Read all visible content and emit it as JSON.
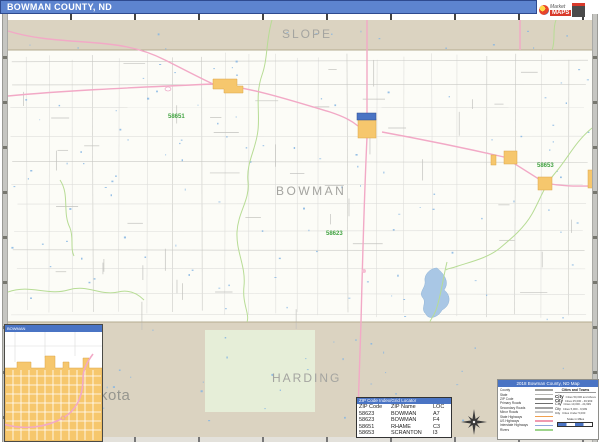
{
  "title_bar": {
    "title": "BOWMAN COUNTY, ND",
    "bg": "#5d84cf"
  },
  "logo": {
    "word1": "Market",
    "word2": "MAPS"
  },
  "map": {
    "neighbor_top": "SLOPE",
    "county": "BOWMAN",
    "neighbor_bottom": "HARDING",
    "partial_state_label": "kota",
    "zip_labels": [
      "58651",
      "58623",
      "58653"
    ],
    "colors": {
      "neighbor_band": "#dbd3c1",
      "county_fill": "#fcfcf7",
      "highway": "#f2a9c6",
      "stream": "#b7dc95",
      "water": "#a9c7e5",
      "city_fill": "#f6c76d",
      "zip_text": "#43a343"
    }
  },
  "inset": {
    "title": "BOWMAN"
  },
  "zip_table": {
    "header": "ZIP Code Index/Grid Locator",
    "columns": [
      "ZIP Code",
      "ZIP Name",
      "LOC"
    ],
    "rows": [
      [
        "58623",
        "BOWMAN",
        "A7"
      ],
      [
        "58623",
        "BOWMAN",
        "F4"
      ],
      [
        "58651",
        "RHAME",
        "C3"
      ],
      [
        "58653",
        "SCRANTON",
        "I3"
      ]
    ]
  },
  "legend": {
    "title": "2018 Bowman County, ND Map",
    "boundary_items": [
      {
        "label": "County",
        "color": "#a0a09c"
      },
      {
        "label": "State",
        "color": "#b8b8b4"
      },
      {
        "label": "ZIP Code",
        "color": "#989894"
      },
      {
        "label": "Primary Roads",
        "color": "#6e6e6e"
      },
      {
        "label": "Secondary Roads",
        "color": "#a2a2a2"
      },
      {
        "label": "Minor Roads",
        "color": "#c8c8c8"
      },
      {
        "label": "State Highways",
        "color": "#f0a050"
      },
      {
        "label": "US Highways",
        "color": "#f09ab0"
      },
      {
        "label": "Interstate Highways",
        "color": "#8fa8dc"
      },
      {
        "label": "Rivers",
        "color": "#9ed48c"
      }
    ],
    "cities_header": "Cities and Towns",
    "city_rows": [
      {
        "sample": "City",
        "desc": "Cities 50,000 and Above"
      },
      {
        "sample": "City",
        "desc": "Cities 25,000 - 49,999"
      },
      {
        "sample": "City",
        "desc": "Cities 10,000 - 24,999"
      },
      {
        "sample": "City",
        "desc": "Cities 5,000 - 9,999"
      },
      {
        "sample": "City",
        "desc": "Cities Under 5,000"
      }
    ],
    "scale_label": "Scale in Miles"
  }
}
